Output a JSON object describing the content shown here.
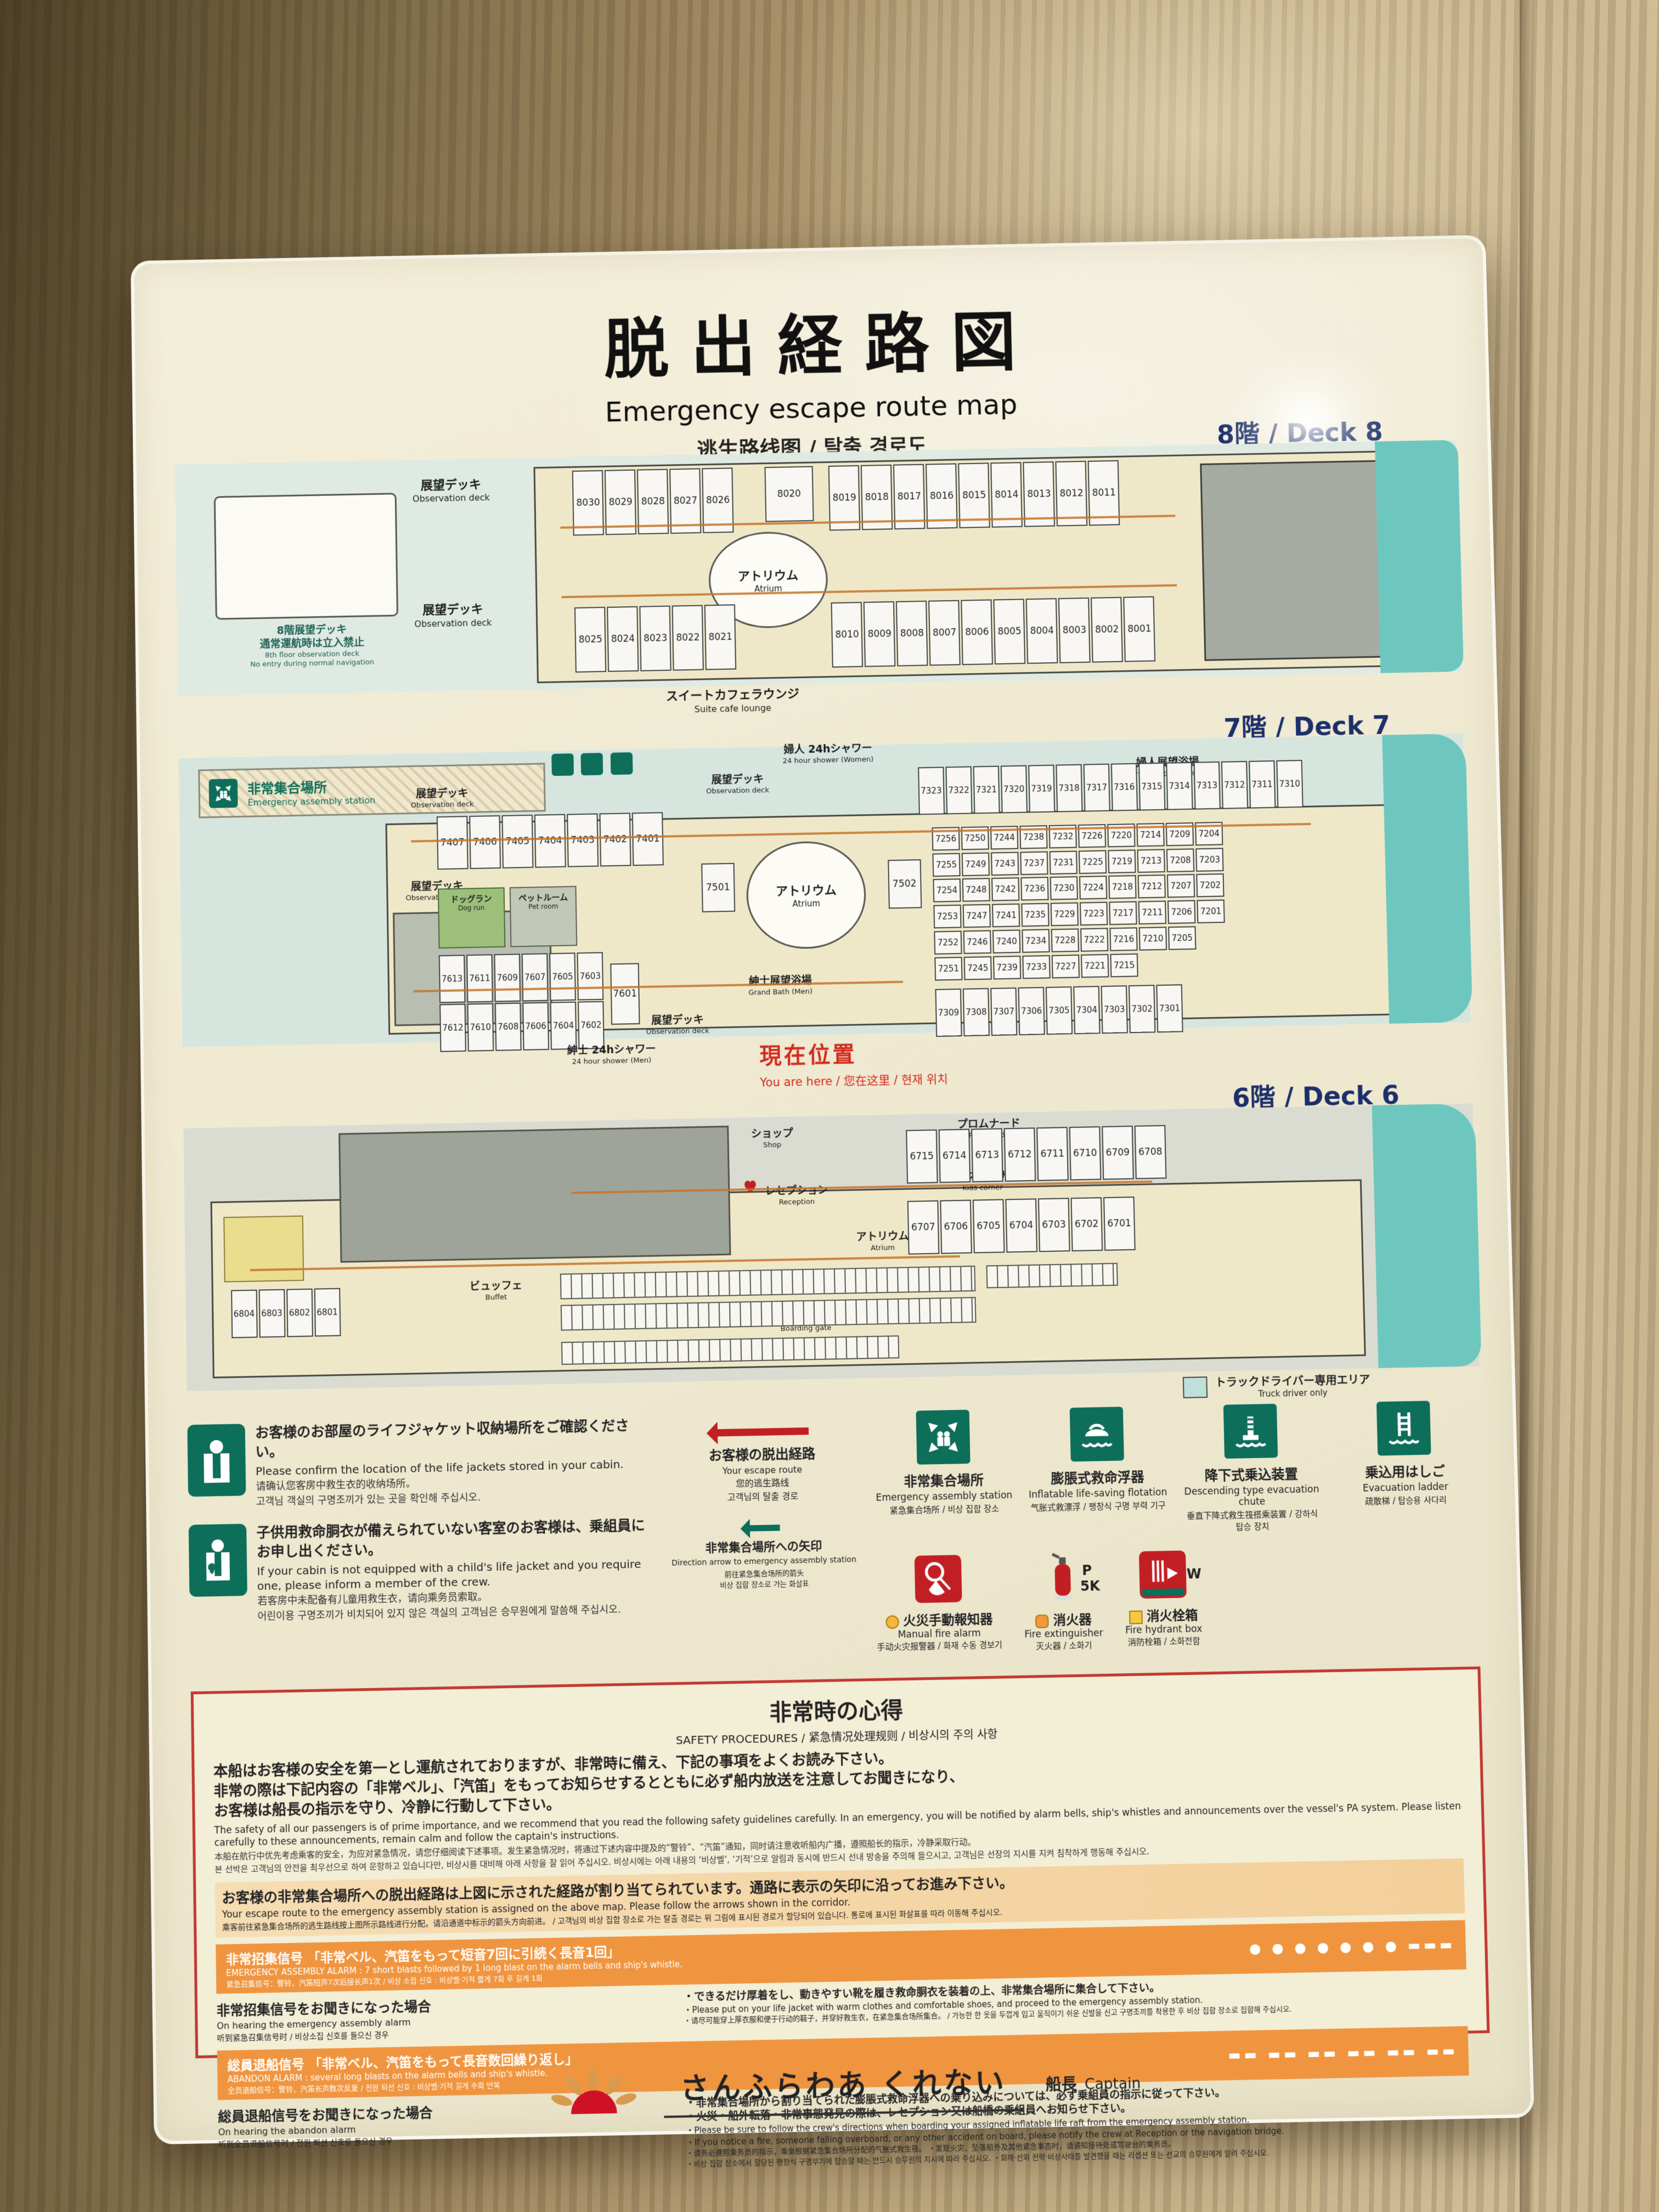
{
  "title": {
    "jp": "脱出経路図",
    "en": "Emergency escape route map",
    "multi": "逃生路线图 / 탈출 경로도"
  },
  "common": {
    "obs": {
      "jp": "展望デッキ",
      "en": "Observation deck"
    },
    "atrium": {
      "jp": "アトリウム",
      "en": "Atrium"
    }
  },
  "deck8": {
    "label": "8階 / Deck 8",
    "restrict": {
      "jp1": "8階展望デッキ",
      "jp2": "通常運航時は立入禁止",
      "en1": "8th floor observation deck",
      "en2": "No entry during normal navigation"
    },
    "suite": {
      "jp": "スイートカフェラウンジ",
      "en": "Suite cafe lounge"
    },
    "cabins_top_left": [
      "8030",
      "8029",
      "8028",
      "8027",
      "8026"
    ],
    "cabin_single": "8020",
    "cabins_top_right": [
      "8019",
      "8018",
      "8017",
      "8016",
      "8015",
      "8014",
      "8013",
      "8012",
      "8011"
    ],
    "cabins_bottom_left": [
      "8025",
      "8024",
      "8023",
      "8022",
      "8021"
    ],
    "cabins_bottom_right": [
      "8010",
      "8009",
      "8008",
      "8007",
      "8006",
      "8005",
      "8004",
      "8003",
      "8002",
      "8001"
    ]
  },
  "deck7": {
    "label": "7階 / Deck 7",
    "assembly": {
      "jp": "非常集合場所",
      "en": "Emergency assembly station"
    },
    "shower_w": {
      "jp": "婦人 24hシャワー",
      "en": "24 hour shower (Women)"
    },
    "bath_w": {
      "jp": "婦人展望浴場",
      "en": "Grand Bath (Women)"
    },
    "bath_m": {
      "jp": "紳士展望浴場",
      "en": "Grand Bath (Men)"
    },
    "shower_m": {
      "jp": "紳士 24hシャワー",
      "en": "24 hour shower (Men)"
    },
    "dogrun": {
      "jp": "ドッグラン",
      "en": "Dog run"
    },
    "petroom": {
      "jp": "ペットルーム",
      "en": "Pet room"
    },
    "here": {
      "jp": "現在位置",
      "sub": "You are here / 您在这里 / 현재 위치"
    },
    "cabins_top": [
      "7407",
      "7406",
      "7405",
      "7404",
      "7403",
      "7402",
      "7401"
    ],
    "left_grid": [
      [
        "7613",
        "7611",
        "7609",
        "7607",
        "7605",
        "7603"
      ],
      [
        "7612",
        "7610",
        "7608",
        "7606",
        "7604",
        "7602"
      ]
    ],
    "corner": "7601",
    "side_a": "7501",
    "side_b": "7502",
    "right_top": [
      "7323",
      "7322",
      "7321",
      "7320",
      "7319",
      "7318",
      "7317",
      "7316",
      "7315",
      "7314",
      "7313",
      "7312",
      "7311",
      "7310"
    ],
    "grid": [
      [
        "7256",
        "7250",
        "7244",
        "7238",
        "7232",
        "7226",
        "7220",
        "7214",
        "7209",
        "7204"
      ],
      [
        "7255",
        "7249",
        "7243",
        "7237",
        "7231",
        "7225",
        "7219",
        "7213",
        "7208",
        "7203"
      ],
      [
        "7254",
        "7248",
        "7242",
        "7236",
        "7230",
        "7224",
        "7218",
        "7212",
        "7207",
        "7202"
      ],
      [
        "7253",
        "7247",
        "7241",
        "7235",
        "7229",
        "7223",
        "7217",
        "7211",
        "7206",
        "7201"
      ],
      [
        "7252",
        "7246",
        "7240",
        "7234",
        "7228",
        "7222",
        "7216",
        "7210",
        "7205"
      ],
      [
        "7251",
        "7245",
        "7239",
        "7233",
        "7227",
        "7221",
        "7215"
      ]
    ],
    "bottom": [
      "7309",
      "7308",
      "7307",
      "7306",
      "7305",
      "7304",
      "7303",
      "7302",
      "7301"
    ]
  },
  "deck6": {
    "label": "6階 / Deck 6",
    "shop": {
      "jp": "ショップ",
      "en": "Shop"
    },
    "reception": {
      "jp": "レセプション",
      "en": "Reception"
    },
    "promenade": {
      "jp": "プロムナード",
      "en": "Promenade"
    },
    "kids": {
      "jp": "キッズコーナー",
      "en": "Kids corner"
    },
    "buffet": {
      "jp": "ビュッフェ",
      "en": "Buffet"
    },
    "restaurant": {
      "jp": "レストラン",
      "en": "Restaurant"
    },
    "boarding": {
      "jp": "乗下船口",
      "en": "Boarding gate"
    },
    "truck": {
      "jp": "トラックドライバー専用エリア",
      "en": "Truck driver only"
    },
    "cabins_top": [
      "6715",
      "6714",
      "6713",
      "6712",
      "6711",
      "6710",
      "6709",
      "6708"
    ],
    "cabins_second": [
      "6707",
      "6706",
      "6705",
      "6704",
      "6703",
      "6702",
      "6701"
    ],
    "left_small": [
      "6804",
      "6803",
      "6802",
      "6801"
    ]
  },
  "legend": {
    "life1": {
      "jp": "お客様のお部屋のライフジャケット収納場所をご確認ください。",
      "en": "Please confirm the location of the life jackets stored in your cabin.",
      "zh": "请确认您客房中救生衣的收纳场所。",
      "ko": "고객님 객실의 구명조끼가 있는 곳을 확인해 주십시오."
    },
    "life2": {
      "jp": "子供用救命胴衣が備えられていない客室のお客様は、乗組員にお申し出ください。",
      "en": "If your cabin is not equipped with a child's life jacket and you require one, please inform a member of the crew.",
      "zh": "若客房中未配备有儿童用救生衣，请向乘务员索取。",
      "ko": "어린이용 구명조끼가 비치되어 있지 않은 객실의 고객님은 승무원에게 말씀해 주십시오."
    },
    "route": {
      "jp": "お客様の脱出経路",
      "sub": "Your escape route\n您的逃生路线\n고객님의 탈출 경로"
    },
    "direction": {
      "jp": "非常集合場所への矢印",
      "en": "Direction arrow to emergency assembly station",
      "sub": "前往紧急集合场所的箭头\n비상 집합 장소로 가는 화살표"
    },
    "assembly": {
      "jp": "非常集合場所",
      "en": "Emergency assembly station",
      "sub": "紧急集合场所 / 비상 집합 장소"
    },
    "raft": {
      "jp": "膨脹式救命浮器",
      "en": "Inflatable life-saving flotation",
      "sub": "气胀式救漂浮 / 팽창식 구명 부력 기구"
    },
    "chute": {
      "jp": "降下式乗込装置",
      "en": "Descending type evacuation chute",
      "sub": "垂直下降式救生筏搭乘装置 / 강하식 탑승 장치"
    },
    "ladder": {
      "jp": "乗込用はしご",
      "en": "Evacuation ladder",
      "sub": "疏散梯 / 탑승용 사다리"
    },
    "alarm": {
      "jp": "火災手動報知器",
      "en": "Manual fire alarm",
      "sub": "手动火灾报警器 / 화재 수동 경보기"
    },
    "ext": {
      "jp": "消火器",
      "en": "Fire extinguisher",
      "sub": "灭火器 / 소화기",
      "badge1": "P",
      "badge2": "5K"
    },
    "hydrant": {
      "jp": "消火栓箱",
      "en": "Fire hydrant box",
      "sub": "消防栓箱 / 소화전함",
      "badge": "W"
    }
  },
  "safety": {
    "title_jp": "非常時の心得",
    "title_sub": "SAFETY PROCEDURES / 紧急情况处理规则 / 비상시의 주의 사항",
    "p1_jp": "本船はお客様の安全を第一とし運航されておりますが、非常時に備え、下記の事項をよくお読み下さい。\n非常の際は下記内容の「非常ベル」、「汽笛」をもってお知らせするとともに必ず船内放送を注意してお聞きになり、\nお客様は船長の指示を守り、冷静に行動して下さい。",
    "p1_en": "The safety of all our passengers is of prime importance, and we recommend that you read the following safety guidelines carefully.  In an emergency, you will be notified by alarm bells, ship's whistles and announcements over the vessel's PA system.  Please listen carefully to these announcements, remain calm and follow the captain's instructions.",
    "p1_zh": "本船在航行中优先考虑乘客的安全，为应对紧急情况，请您仔细阅读下述事项。发生紧急情况时，将通过下述内容中提及的“警铃”、“汽笛”通知，同时请注意收听船内广播，遵照船长的指示，冷静采取行动。",
    "p1_ko": "본 선박은 고객님의 안전을 최우선으로 하여 운항하고 있습니다만, 비상시를 대비해 아래 사항을 잘 읽어 주십시오. 비상시에는 아래 내용의 ‘비상벨’, ‘기적’으로 알림과 동시에 반드시 선내 방송을 주의해 들으시고, 고객님은 선장의 지시를 지켜 침착하게 행동해 주십시오.",
    "p2_jp": "お客様の非常集合場所への脱出経路は上図に示された経路が割り当てられています。通路に表示の矢印に沿ってお進み下さい。",
    "p2_en": "Your escape route to the emergency assembly station is assigned on the above map. Please follow the arrows shown in the corridor.",
    "p2_sub": "乘客前往紧急集合场所的逃生路线按上图所示路线进行分配。请沿通道中标示的箭头方向前进。 / 고객님의 비상 집합 장소로 가는 탈출 경로는 위 그림에 표시된 경로가 할당되어 있습니다. 통로에 표시된 화살표를 따라 이동해 주십시오.",
    "band1_jp": "非常招集信号 「非常ベル、汽笛をもって短音7回に引続く長音1回」",
    "band1_en": "EMERGENCY ASSEMBLY ALARM : 7 short blasts followed by 1 long blast on the alarm bells and ship's whistle.",
    "band1_sub": "紧急召集信号：警铃、汽笛短声7次后接长声1次 / 비상 소집 신호 : 비상벨·기적 짧게 7회 후 길게 1회",
    "band1_signal": "● ● ● ● ● ● ●  ▬▬▬",
    "sec1_jp": "非常招集信号をお聞きになった場合",
    "sec1_en": "On hearing the emergency assembly alarm",
    "sec1_sub": "听到紧急召集信号时 / 비상소집 신호를 들으신 경우",
    "sec1_b_jp": "・できるだけ厚着をし、動きやすい靴を履き救命胴衣を装着の上、非常集合場所に集合して下さい。",
    "sec1_b_en": "・Please put on your life jacket with warm clothes and comfortable shoes, and proceed to the emergency assembly station.",
    "sec1_b_sub": "・请尽可能穿上厚衣服和便于行动的鞋子，并穿好救生衣，在紧急集合场所集合。 / 가능한 한 옷을 두껍게 입고 움직이기 쉬운 신발을 신고 구명조끼를 착용한 후 비상 집합 장소로 집합해 주십시오.",
    "band2_jp": "総員退船信号 「非常ベル、汽笛をもって長音数回繰り返し」",
    "band2_en": "ABANDON ALARM : several long blasts on the alarm bells and ship's whistle.",
    "band2_sub": "全员退船信号：警铃、汽笛长声数次反复 / 전원 퇴선 신호 : 비상벨·기적 길게 수회 반복",
    "band2_signal": "▬▬ ▬▬ ▬▬ ▬▬ ▬▬ ▬▬",
    "sec2_jp": "総員退船信号をお聞きになった場合",
    "sec2_en": "On hearing the abandon alarm",
    "sec2_sub": "听到全员退船信号时 / 전원 퇴선 신호를 들으신 경우",
    "sec2_b1_jp": "・非常集合場所から割り当てられた膨脹式救命浮器への乗り込みについては、必ず乗組員の指示に従って下さい。",
    "sec2_b2_jp": "・火災・船外転落・非常事態発見の際は、レセプション又は船橋の乗組員へお知らせ下さい。",
    "sec2_b1_en": "・Please be sure to follow the crew's directions when boarding your assigned inflatable life raft from the emergency assembly station.",
    "sec2_b2_en": "・If you notice a fire, someone falling overboard, or any other accident on board, please notify the crew at Reception or the navigation bridge.",
    "sec2_b_zh": "・请务必遵照乘务员的指示，乘坐根据紧急集合场所分配的气胀式救生筏。 ・发现火灾、坠落船外及其他紧急事态时，请通知接待处或驾驶台的乘务员。",
    "sec2_b_ko": "・비상 집합 장소에서 할당된 팽창식 구명부기에 탑승할 때는 반드시 승무원의 지시에 따라 주십시오. ・화재·선외 전락·비상사태를 발견했을 때는 리셉션 또는 선교의 승무원에게 알려 주십시오."
  },
  "footer": {
    "ship": "さんふらわあ くれない",
    "captain_jp": "船長",
    "captain_en": "Captain"
  },
  "colors": {
    "sea": "#6ec7bf",
    "hull": "#efe8c8",
    "orange_band": "#f0953f",
    "green_icon": "#0d6e5a",
    "red": "#d42a1e",
    "navy": "#1b2f6b"
  }
}
